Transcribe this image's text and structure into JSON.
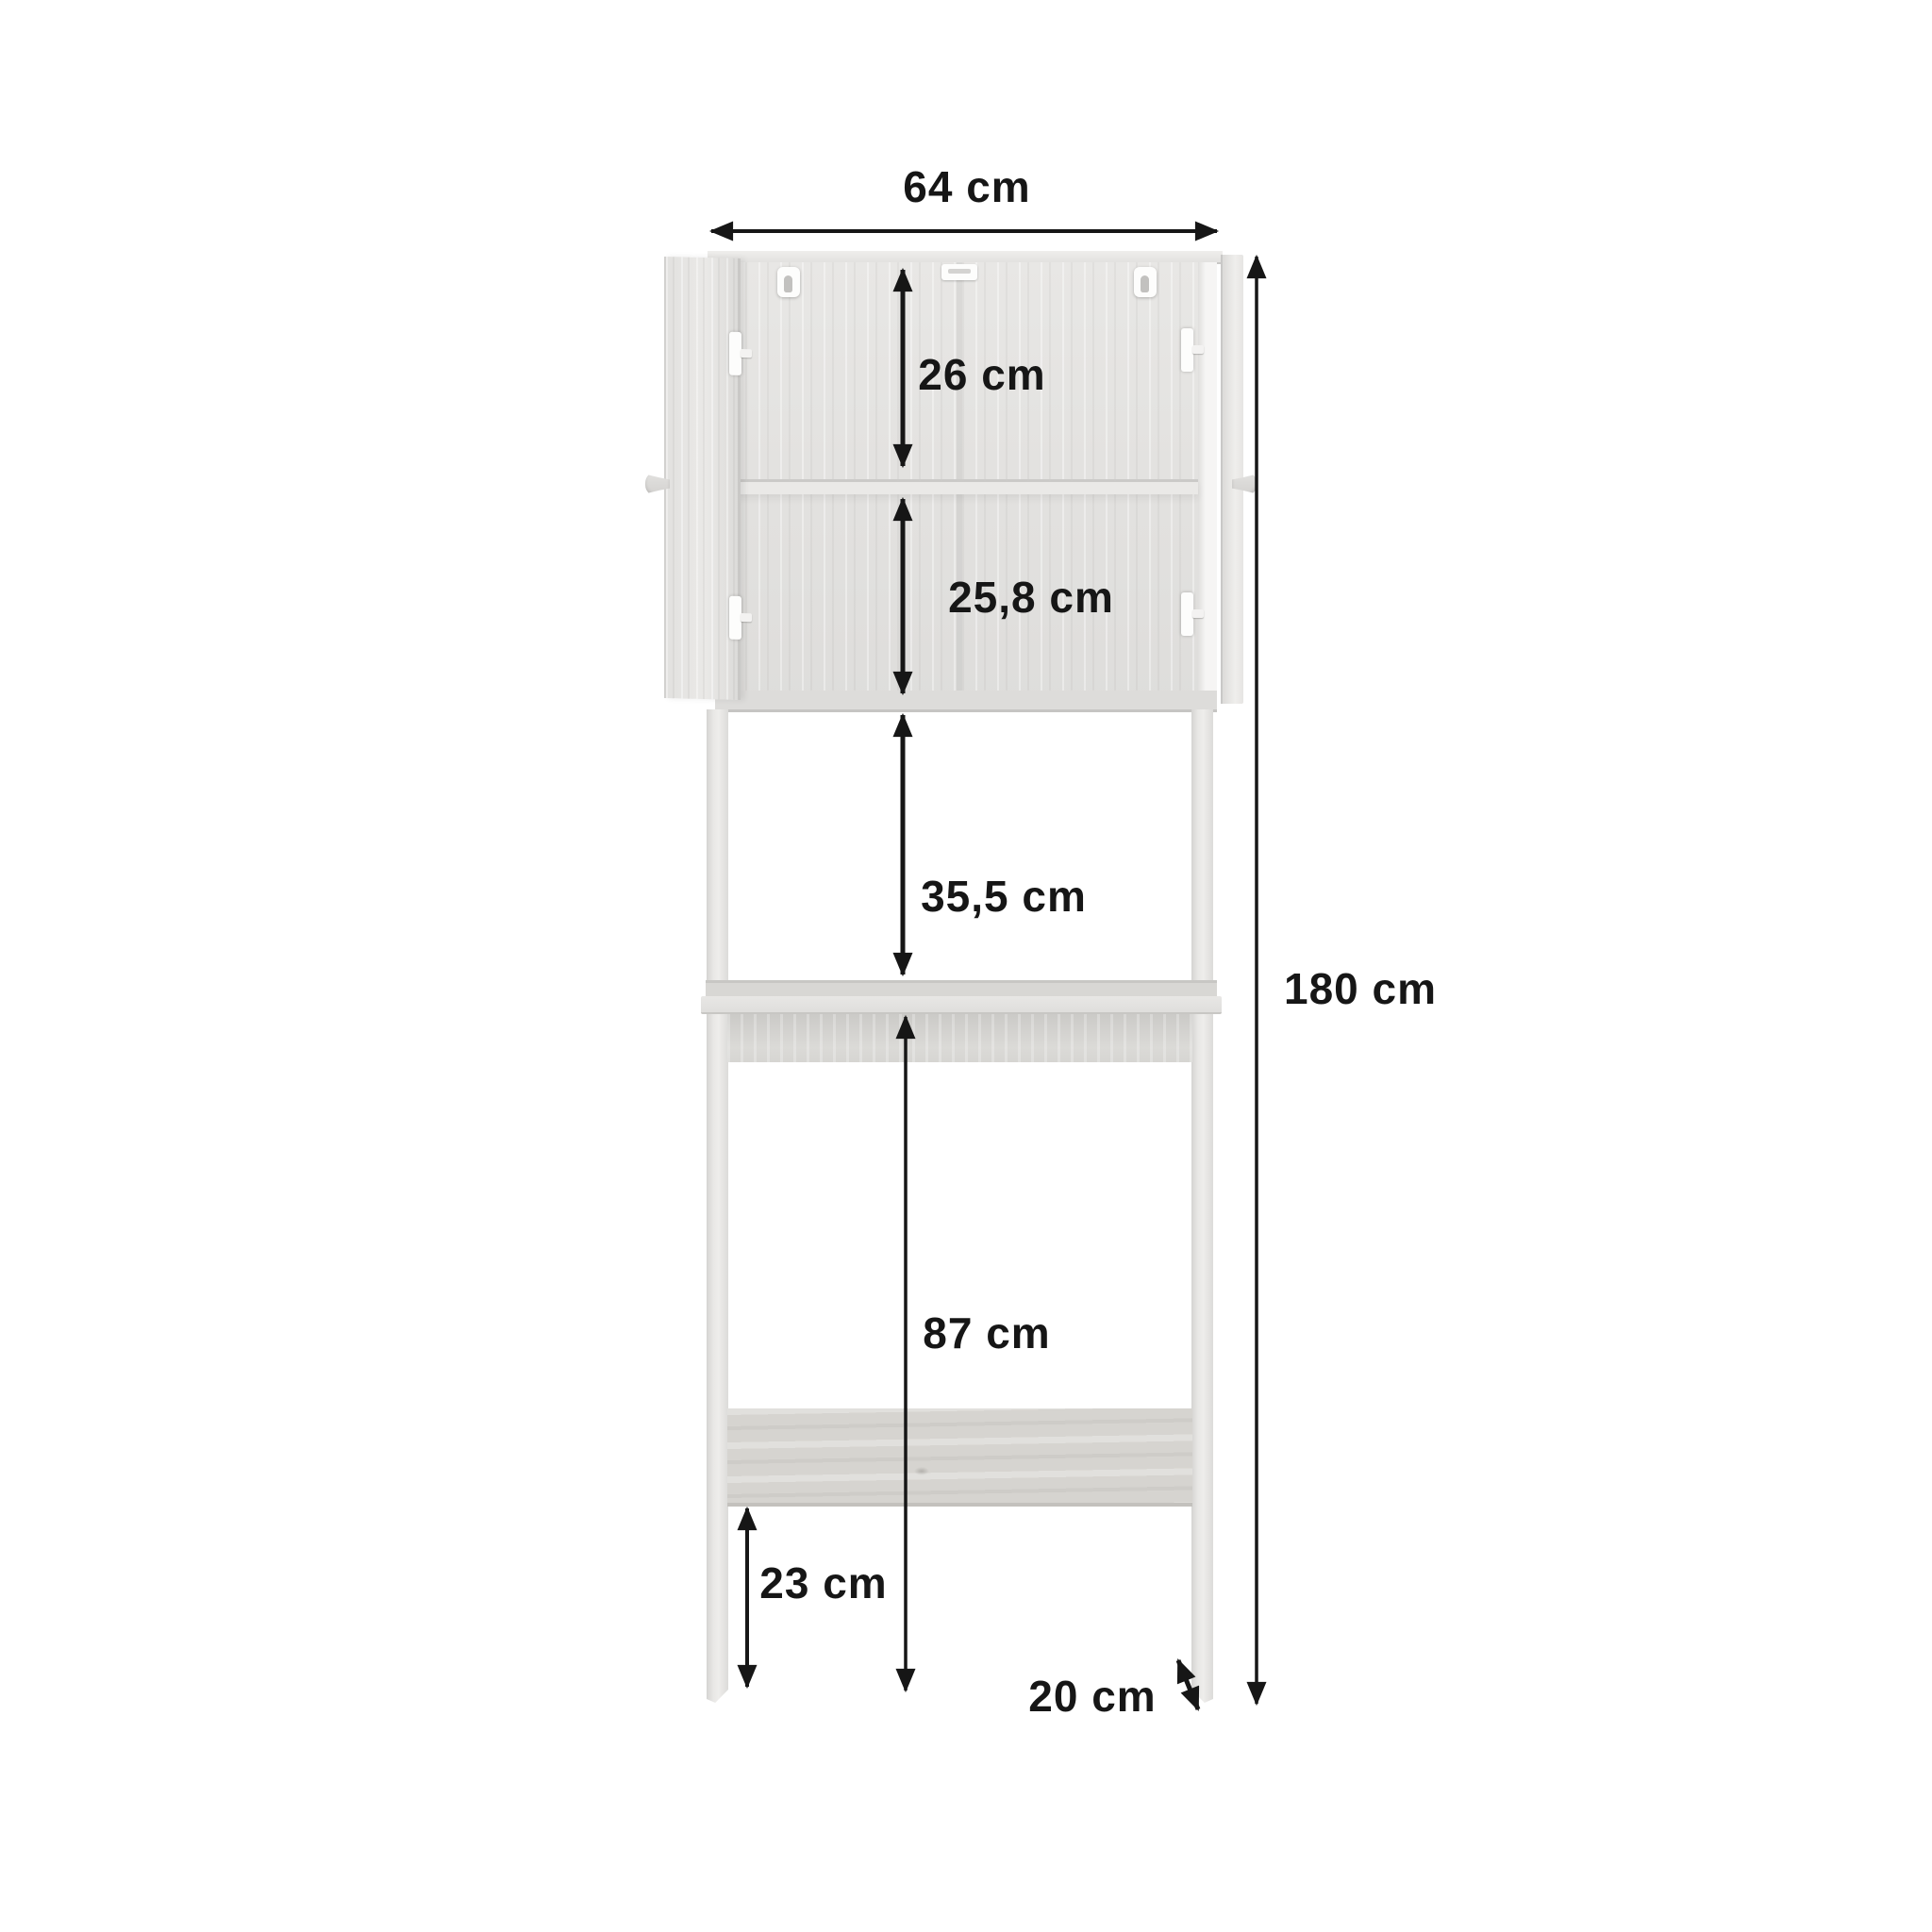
{
  "unit": "cm",
  "dimensions": {
    "overall_width": {
      "label": "64 cm",
      "value": 64,
      "orientation": "horizontal"
    },
    "upper_compartment_height": {
      "label": "26 cm",
      "value": 26,
      "orientation": "vertical"
    },
    "lower_compartment_height": {
      "label": "25,8 cm",
      "value": 25.8,
      "orientation": "vertical"
    },
    "cabinet_to_shelf_gap": {
      "label": "35,5 cm",
      "value": 35.5,
      "orientation": "vertical"
    },
    "shelf_to_floor_clearance": {
      "label": "87 cm",
      "value": 87,
      "orientation": "vertical"
    },
    "stretcher_to_floor": {
      "label": "23 cm",
      "value": 23,
      "orientation": "vertical"
    },
    "side_panel_depth": {
      "label": "20 cm",
      "value": 20,
      "orientation": "diagonal"
    },
    "overall_height": {
      "label": "180 cm",
      "value": 180,
      "orientation": "vertical"
    }
  },
  "colors": {
    "ink": "#161616",
    "bg": "#ffffff",
    "wood-light": "#e9e8e6",
    "wood-mid": "#e0dfdd",
    "wood-dark": "#cfcecb",
    "wood-edge": "#c6c5c2",
    "stretcher": "#d6d4d0",
    "hardware": "#fdfdfc"
  }
}
